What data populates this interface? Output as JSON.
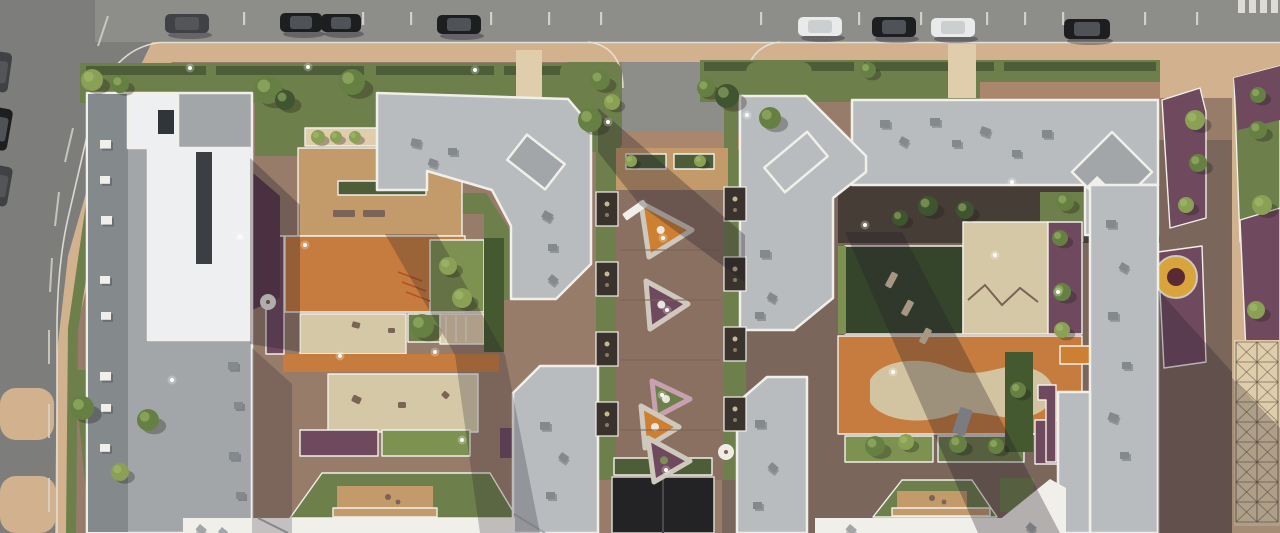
{
  "scene": {
    "label": "Aerial rendering of a residential complex with two courtyard blocks, playgrounds and a central pedestrian boulevard"
  },
  "palette": {
    "road": "#8d8d8a",
    "roadDark": "#7d7e7c",
    "asphaltLine": "#e7e3da",
    "tan": "#d2b28e",
    "tanLight": "#e0cdab",
    "offwhite": "#efece4",
    "brickMid": "#977c6a",
    "brickDark": "#7a665a",
    "brickRed": "#aa876c",
    "wood": "#c39a6a",
    "woodDark": "#8a7061",
    "plank": "#7b6355",
    "orange": "#c67c3e",
    "sand": "#d4c8a6",
    "lawnMid": "#6d7f4b",
    "lawnBright": "#87a055",
    "lawnDark": "#35452c",
    "hedge": "#4c5d38",
    "bush": "#7d9150",
    "bushDark": "#44592f",
    "mulch": "#473d37",
    "purpleFl": "#6f4a5f",
    "flowerOrange": "#cd8031",
    "flowerRed": "#b55026",
    "pinkBorder": "#c9a0b0",
    "roofLight": "#b9bcbe",
    "roofMid": "#a2a6a9",
    "roofDark": "#84898c",
    "towerWhite": "#edeff0",
    "parapet": "#f1efe9",
    "maroon": "#5e3a4e",
    "treeBright": "#8aa055",
    "treeMid": "#668043",
    "treeDark": "#3e5530",
    "carBlack": "#1d1e20",
    "carWhite": "#e9eaea",
    "carDark": "#3f4144",
    "shadow": "#211a28",
    "lattice": "#463c33",
    "gate": "#232326",
    "bedRim": "#cfc9bd",
    "flowerRingCenter": "#5a2a34",
    "slot": "#3b3f43"
  },
  "cars_top": [
    {
      "x": 165,
      "y": 14,
      "w": 44,
      "h": 19,
      "color": "carDark"
    },
    {
      "x": 280,
      "y": 13,
      "w": 42,
      "h": 19,
      "color": "carBlack"
    },
    {
      "x": 321,
      "y": 14,
      "w": 40,
      "h": 18,
      "color": "carBlack"
    },
    {
      "x": 437,
      "y": 15,
      "w": 44,
      "h": 19,
      "color": "carBlack"
    },
    {
      "x": 798,
      "y": 17,
      "w": 44,
      "h": 19,
      "color": "carWhite"
    },
    {
      "x": 872,
      "y": 17,
      "w": 44,
      "h": 20,
      "color": "carBlack"
    },
    {
      "x": 931,
      "y": 18,
      "w": 44,
      "h": 19,
      "color": "carWhite"
    },
    {
      "x": 1064,
      "y": 19,
      "w": 46,
      "h": 20,
      "color": "carBlack"
    }
  ],
  "cars_left": [
    {
      "x": -8,
      "y": 52,
      "w": 18,
      "h": 40,
      "rot": 8,
      "color": "carDark"
    },
    {
      "x": -10,
      "y": 108,
      "w": 20,
      "h": 42,
      "rot": 10,
      "color": "carBlack"
    },
    {
      "x": -8,
      "y": 166,
      "w": 18,
      "h": 40,
      "rot": 10,
      "color": "carDark"
    }
  ],
  "parking_ticks": [
    243,
    362,
    410,
    490,
    548,
    600,
    760,
    858,
    920,
    986,
    1024,
    1062,
    1144,
    1196
  ],
  "crosswalk": {
    "x": 1238,
    "y": 0,
    "count": 4,
    "w": 7,
    "h": 13,
    "step": 11
  },
  "roof_vents": [
    {
      "x": 100,
      "y": 140,
      "s": 11,
      "rot": 0,
      "tone": "parapet"
    },
    {
      "x": 100,
      "y": 176,
      "s": 10,
      "rot": 0,
      "tone": "parapet"
    },
    {
      "x": 101,
      "y": 216,
      "s": 11,
      "rot": 0,
      "tone": "parapet"
    },
    {
      "x": 100,
      "y": 276,
      "s": 10,
      "rot": 0,
      "tone": "parapet"
    },
    {
      "x": 101,
      "y": 312,
      "s": 10,
      "rot": 0,
      "tone": "parapet"
    },
    {
      "x": 100,
      "y": 372,
      "s": 11,
      "rot": 0,
      "tone": "parapet"
    },
    {
      "x": 101,
      "y": 404,
      "s": 10,
      "rot": 0,
      "tone": "parapet"
    },
    {
      "x": 100,
      "y": 444,
      "s": 10,
      "rot": 0,
      "tone": "parapet"
    },
    {
      "x": 228,
      "y": 362,
      "s": 10,
      "rot": 0,
      "tone": "roofDark"
    },
    {
      "x": 234,
      "y": 402,
      "s": 9,
      "rot": 0,
      "tone": "roofDark"
    },
    {
      "x": 229,
      "y": 452,
      "s": 10,
      "rot": 0,
      "tone": "roofDark"
    },
    {
      "x": 236,
      "y": 492,
      "s": 9,
      "rot": 0,
      "tone": "roofDark"
    },
    {
      "x": 412,
      "y": 138,
      "s": 10,
      "rot": 12,
      "tone": "roofDark"
    },
    {
      "x": 448,
      "y": 148,
      "s": 9,
      "rot": 0,
      "tone": "roofDark"
    },
    {
      "x": 430,
      "y": 158,
      "s": 9,
      "rot": 20,
      "tone": "roofDark"
    },
    {
      "x": 545,
      "y": 210,
      "s": 10,
      "rot": 30,
      "tone": "roofDark"
    },
    {
      "x": 548,
      "y": 244,
      "s": 9,
      "rot": 0,
      "tone": "roofDark"
    },
    {
      "x": 552,
      "y": 274,
      "s": 9,
      "rot": 40,
      "tone": "roofDark"
    },
    {
      "x": 880,
      "y": 120,
      "s": 10,
      "rot": 0,
      "tone": "roofDark"
    },
    {
      "x": 902,
      "y": 136,
      "s": 9,
      "rot": 30,
      "tone": "roofDark"
    },
    {
      "x": 930,
      "y": 118,
      "s": 10,
      "rot": 0,
      "tone": "roofDark"
    },
    {
      "x": 952,
      "y": 140,
      "s": 9,
      "rot": 0,
      "tone": "roofDark"
    },
    {
      "x": 982,
      "y": 126,
      "s": 10,
      "rot": 20,
      "tone": "roofDark"
    },
    {
      "x": 1012,
      "y": 150,
      "s": 9,
      "rot": 0,
      "tone": "roofDark"
    },
    {
      "x": 1042,
      "y": 130,
      "s": 10,
      "rot": 0,
      "tone": "roofDark"
    },
    {
      "x": 760,
      "y": 250,
      "s": 10,
      "rot": 0,
      "tone": "roofDark"
    },
    {
      "x": 770,
      "y": 292,
      "s": 9,
      "rot": 30,
      "tone": "roofDark"
    },
    {
      "x": 755,
      "y": 312,
      "s": 9,
      "rot": 0,
      "tone": "roofDark"
    },
    {
      "x": 1106,
      "y": 220,
      "s": 10,
      "rot": 0,
      "tone": "roofDark"
    },
    {
      "x": 1122,
      "y": 262,
      "s": 9,
      "rot": 30,
      "tone": "roofDark"
    },
    {
      "x": 1108,
      "y": 312,
      "s": 10,
      "rot": 0,
      "tone": "roofDark"
    },
    {
      "x": 1122,
      "y": 362,
      "s": 9,
      "rot": 0,
      "tone": "roofDark"
    },
    {
      "x": 1110,
      "y": 412,
      "s": 10,
      "rot": 20,
      "tone": "roofDark"
    },
    {
      "x": 1120,
      "y": 452,
      "s": 9,
      "rot": 0,
      "tone": "roofDark"
    },
    {
      "x": 755,
      "y": 420,
      "s": 10,
      "rot": 0,
      "tone": "roofDark"
    },
    {
      "x": 772,
      "y": 462,
      "s": 9,
      "rot": 40,
      "tone": "roofDark"
    },
    {
      "x": 753,
      "y": 502,
      "s": 9,
      "rot": 0,
      "tone": "roofDark"
    },
    {
      "x": 540,
      "y": 422,
      "s": 10,
      "rot": 0,
      "tone": "roofDark"
    },
    {
      "x": 562,
      "y": 452,
      "s": 9,
      "rot": 35,
      "tone": "roofDark"
    },
    {
      "x": 546,
      "y": 492,
      "s": 9,
      "rot": 0,
      "tone": "roofDark"
    },
    {
      "x": 200,
      "y": 524,
      "s": 9,
      "rot": 40,
      "tone": "roofMid"
    },
    {
      "x": 222,
      "y": 527,
      "s": 8,
      "rot": 40,
      "tone": "roofMid"
    },
    {
      "x": 850,
      "y": 524,
      "s": 9,
      "rot": 40,
      "tone": "roofMid"
    },
    {
      "x": 1030,
      "y": 522,
      "s": 9,
      "rot": 40,
      "tone": "roofMid"
    }
  ],
  "triangle_beds": [
    {
      "pts": [
        [
          641,
          203
        ],
        [
          692,
          230
        ],
        [
          649,
          257
        ]
      ],
      "fill": "flowerOrange",
      "border": "bedRim",
      "dot": "offwhite"
    },
    {
      "pts": [
        [
          646,
          281
        ],
        [
          688,
          304
        ],
        [
          650,
          329
        ]
      ],
      "fill": "purpleFl",
      "border": "bedRim",
      "dot": "offwhite"
    },
    {
      "pts": [
        [
          652,
          381
        ],
        [
          690,
          399
        ],
        [
          656,
          417
        ]
      ],
      "fill": "lawnMid",
      "border": "pinkBorder",
      "dot": "offwhite"
    },
    {
      "pts": [
        [
          641,
          406
        ],
        [
          679,
          427
        ],
        [
          645,
          448
        ]
      ],
      "fill": "flowerOrange",
      "border": "bedRim",
      "dot": "offwhite"
    },
    {
      "pts": [
        [
          648,
          438
        ],
        [
          690,
          461
        ],
        [
          654,
          482
        ]
      ],
      "fill": "purpleFl",
      "border": "bedRim",
      "dot": "bush"
    }
  ],
  "niches": [
    {
      "x": 596,
      "y": 192
    },
    {
      "x": 596,
      "y": 262
    },
    {
      "x": 596,
      "y": 332
    },
    {
      "x": 596,
      "y": 402
    },
    {
      "x": 724,
      "y": 187
    },
    {
      "x": 724,
      "y": 257
    },
    {
      "x": 724,
      "y": 327
    },
    {
      "x": 724,
      "y": 397
    }
  ],
  "shadows": [
    {
      "pts": "250,158 300,205 300,352 250,344",
      "op": 0.3
    },
    {
      "pts": "598,108 745,235 745,282 640,205 598,152",
      "op": 0.3
    },
    {
      "pts": "385,234 437,234 505,355 455,355",
      "op": 0.26
    },
    {
      "pts": "455,355 505,355 540,533 480,533",
      "op": 0.24
    },
    {
      "pts": "845,232 902,232 1060,533 978,533",
      "op": 0.3
    },
    {
      "pts": "1158,290 1232,372 1232,533 1158,533",
      "op": 0.28
    },
    {
      "pts": "1232,378 1280,428 1280,533 1232,533",
      "op": 0.26
    },
    {
      "pts": "252,348 292,384 292,533 252,533",
      "op": 0.22
    }
  ],
  "trees": [
    {
      "x": 92,
      "y": 80,
      "r": 11,
      "tone": "treeBright"
    },
    {
      "x": 120,
      "y": 84,
      "r": 9,
      "tone": "treeMid"
    },
    {
      "x": 268,
      "y": 90,
      "r": 14,
      "tone": "treeMid"
    },
    {
      "x": 285,
      "y": 100,
      "r": 10,
      "tone": "treeDark"
    },
    {
      "x": 352,
      "y": 82,
      "r": 13,
      "tone": "treeMid"
    },
    {
      "x": 600,
      "y": 80,
      "r": 10,
      "tone": "treeMid"
    },
    {
      "x": 612,
      "y": 102,
      "r": 8,
      "tone": "treeBright"
    },
    {
      "x": 590,
      "y": 120,
      "r": 12,
      "tone": "treeMid"
    },
    {
      "x": 770,
      "y": 118,
      "r": 11,
      "tone": "treeMid"
    },
    {
      "x": 706,
      "y": 88,
      "r": 9,
      "tone": "treeMid"
    },
    {
      "x": 727,
      "y": 96,
      "r": 12,
      "tone": "treeDark"
    },
    {
      "x": 868,
      "y": 70,
      "r": 8,
      "tone": "treeMid"
    },
    {
      "x": 1195,
      "y": 120,
      "r": 10,
      "tone": "treeBright"
    },
    {
      "x": 1198,
      "y": 163,
      "r": 9,
      "tone": "treeMid"
    },
    {
      "x": 1258,
      "y": 130,
      "r": 9,
      "tone": "treeMid"
    },
    {
      "x": 1262,
      "y": 205,
      "r": 10,
      "tone": "treeBright"
    },
    {
      "x": 1256,
      "y": 310,
      "r": 9,
      "tone": "treeBright"
    },
    {
      "x": 1186,
      "y": 205,
      "r": 8,
      "tone": "treeBright"
    },
    {
      "x": 422,
      "y": 326,
      "r": 12,
      "tone": "treeMid"
    },
    {
      "x": 448,
      "y": 266,
      "r": 9,
      "tone": "treeBright"
    },
    {
      "x": 462,
      "y": 298,
      "r": 10,
      "tone": "treeBright"
    },
    {
      "x": 318,
      "y": 137,
      "r": 7,
      "tone": "treeBright"
    },
    {
      "x": 336,
      "y": 137,
      "r": 6,
      "tone": "treeBright"
    },
    {
      "x": 355,
      "y": 137,
      "r": 6,
      "tone": "treeBright"
    },
    {
      "x": 928,
      "y": 206,
      "r": 10,
      "tone": "treeDark"
    },
    {
      "x": 965,
      "y": 210,
      "r": 9,
      "tone": "treeDark"
    },
    {
      "x": 900,
      "y": 218,
      "r": 8,
      "tone": "treeDark"
    },
    {
      "x": 1065,
      "y": 202,
      "r": 9,
      "tone": "treeMid"
    },
    {
      "x": 875,
      "y": 446,
      "r": 10,
      "tone": "treeMid"
    },
    {
      "x": 906,
      "y": 442,
      "r": 8,
      "tone": "treeBright"
    },
    {
      "x": 958,
      "y": 444,
      "r": 9,
      "tone": "treeMid"
    },
    {
      "x": 996,
      "y": 446,
      "r": 8,
      "tone": "treeMid"
    },
    {
      "x": 1060,
      "y": 238,
      "r": 8,
      "tone": "treeMid"
    },
    {
      "x": 1062,
      "y": 292,
      "r": 9,
      "tone": "treeMid"
    },
    {
      "x": 1062,
      "y": 330,
      "r": 8,
      "tone": "treeBright"
    },
    {
      "x": 82,
      "y": 408,
      "r": 12,
      "tone": "treeMid"
    },
    {
      "x": 148,
      "y": 420,
      "r": 11,
      "tone": "treeMid"
    },
    {
      "x": 120,
      "y": 472,
      "r": 9,
      "tone": "treeBright"
    },
    {
      "x": 631,
      "y": 161,
      "r": 6,
      "tone": "treeBright"
    },
    {
      "x": 700,
      "y": 161,
      "r": 6,
      "tone": "treeBright"
    },
    {
      "x": 1018,
      "y": 390,
      "r": 8,
      "tone": "treeMid"
    },
    {
      "x": 1258,
      "y": 95,
      "r": 8,
      "tone": "treeMid"
    }
  ],
  "lights": [
    {
      "x": 190,
      "y": 68
    },
    {
      "x": 308,
      "y": 67
    },
    {
      "x": 475,
      "y": 70
    },
    {
      "x": 608,
      "y": 122
    },
    {
      "x": 747,
      "y": 115
    },
    {
      "x": 663,
      "y": 238
    },
    {
      "x": 667,
      "y": 310
    },
    {
      "x": 662,
      "y": 395
    },
    {
      "x": 666,
      "y": 470
    },
    {
      "x": 340,
      "y": 356
    },
    {
      "x": 435,
      "y": 352
    },
    {
      "x": 305,
      "y": 245
    },
    {
      "x": 240,
      "y": 237
    },
    {
      "x": 893,
      "y": 372
    },
    {
      "x": 865,
      "y": 225
    },
    {
      "x": 995,
      "y": 255
    },
    {
      "x": 1012,
      "y": 182
    },
    {
      "x": 1058,
      "y": 292
    },
    {
      "x": 172,
      "y": 380
    },
    {
      "x": 462,
      "y": 440
    }
  ],
  "props": [
    {
      "type": "rect",
      "x": 333,
      "y": 210,
      "w": 22,
      "h": 7,
      "rot": 0,
      "fill": "plank"
    },
    {
      "type": "rect",
      "x": 363,
      "y": 210,
      "w": 22,
      "h": 7,
      "rot": 0,
      "fill": "plank"
    },
    {
      "type": "rect",
      "x": 622,
      "y": 206,
      "w": 26,
      "h": 8,
      "rot": -35,
      "fill": "parapet"
    },
    {
      "type": "rect",
      "x": 888,
      "y": 272,
      "w": 7,
      "h": 16,
      "rot": 28,
      "fill": "tanLight"
    },
    {
      "type": "rect",
      "x": 904,
      "y": 300,
      "w": 7,
      "h": 16,
      "rot": 28,
      "fill": "tanLight"
    },
    {
      "type": "rect",
      "x": 922,
      "y": 328,
      "w": 7,
      "h": 16,
      "rot": 28,
      "fill": "tanLight"
    },
    {
      "type": "rect",
      "x": 352,
      "y": 322,
      "w": 8,
      "h": 6,
      "rot": 15,
      "fill": "plank"
    },
    {
      "type": "rect",
      "x": 388,
      "y": 328,
      "w": 7,
      "h": 5,
      "rot": 0,
      "fill": "plank"
    },
    {
      "type": "rect",
      "x": 352,
      "y": 396,
      "w": 9,
      "h": 7,
      "rot": 25,
      "fill": "plank"
    },
    {
      "type": "rect",
      "x": 398,
      "y": 402,
      "w": 8,
      "h": 6,
      "rot": 0,
      "fill": "plank"
    },
    {
      "type": "rect",
      "x": 442,
      "y": 392,
      "w": 7,
      "h": 6,
      "rot": 40,
      "fill": "plank"
    },
    {
      "type": "rect",
      "x": 956,
      "y": 408,
      "w": 13,
      "h": 27,
      "rot": 18,
      "fill": "roofMid"
    },
    {
      "type": "line",
      "x1": 398,
      "y1": 272,
      "x2": 422,
      "y2": 281,
      "stroke": "flowerRed",
      "w": 1.5
    },
    {
      "type": "line",
      "x1": 402,
      "y1": 282,
      "x2": 426,
      "y2": 291,
      "stroke": "flowerRed",
      "w": 1.5
    },
    {
      "type": "line",
      "x1": 406,
      "y1": 292,
      "x2": 430,
      "y2": 301,
      "stroke": "flowerRed",
      "w": 1.5
    },
    {
      "type": "poly",
      "pts": "968,300 985,285 1002,305 1020,288 1038,302",
      "stroke": "plank",
      "w": 2,
      "fill": "none"
    },
    {
      "type": "line",
      "x1": 446,
      "y1": 316,
      "x2": 446,
      "y2": 342,
      "stroke": "parapet",
      "w": 1
    },
    {
      "type": "line",
      "x1": 456,
      "y1": 316,
      "x2": 456,
      "y2": 342,
      "stroke": "parapet",
      "w": 1
    },
    {
      "type": "line",
      "x1": 466,
      "y1": 316,
      "x2": 466,
      "y2": 342,
      "stroke": "parapet",
      "w": 1
    },
    {
      "type": "circle",
      "x": 268,
      "y": 302,
      "r": 8,
      "fill": "offwhite"
    },
    {
      "type": "circle",
      "x": 268,
      "y": 302,
      "r": 2,
      "fill": "plank"
    },
    {
      "type": "circle",
      "x": 726,
      "y": 452,
      "r": 8,
      "fill": "offwhite"
    },
    {
      "type": "circle",
      "x": 726,
      "y": 452,
      "r": 2,
      "fill": "plank"
    },
    {
      "type": "circle",
      "x": 388,
      "y": 497,
      "r": 3,
      "fill": "plank"
    },
    {
      "type": "circle",
      "x": 398,
      "y": 502,
      "r": 2.4,
      "fill": "plank"
    },
    {
      "type": "circle",
      "x": 932,
      "y": 498,
      "r": 3,
      "fill": "plank"
    },
    {
      "type": "circle",
      "x": 944,
      "y": 502,
      "r": 2.4,
      "fill": "plank"
    },
    {
      "type": "line",
      "x1": 258,
      "y1": 518,
      "x2": 288,
      "y2": 533,
      "stroke": "roofMid",
      "w": 2
    },
    {
      "type": "line",
      "x1": 514,
      "y1": 514,
      "x2": 545,
      "y2": 533,
      "stroke": "roofMid",
      "w": 2
    },
    {
      "type": "line",
      "x1": 620,
      "y1": 250,
      "x2": 720,
      "y2": 250,
      "stroke": "plank",
      "w": 1
    },
    {
      "type": "line",
      "x1": 620,
      "y1": 300,
      "x2": 720,
      "y2": 300,
      "stroke": "plank",
      "w": 1
    },
    {
      "type": "line",
      "x1": 620,
      "y1": 360,
      "x2": 720,
      "y2": 360,
      "stroke": "plank",
      "w": 1
    },
    {
      "type": "line",
      "x1": 620,
      "y1": 430,
      "x2": 720,
      "y2": 430,
      "stroke": "plank",
      "w": 1
    }
  ],
  "lattice": {
    "x": 1236,
    "y": 342,
    "w": 42,
    "h": 180,
    "cols": 2,
    "rowH": 20
  }
}
